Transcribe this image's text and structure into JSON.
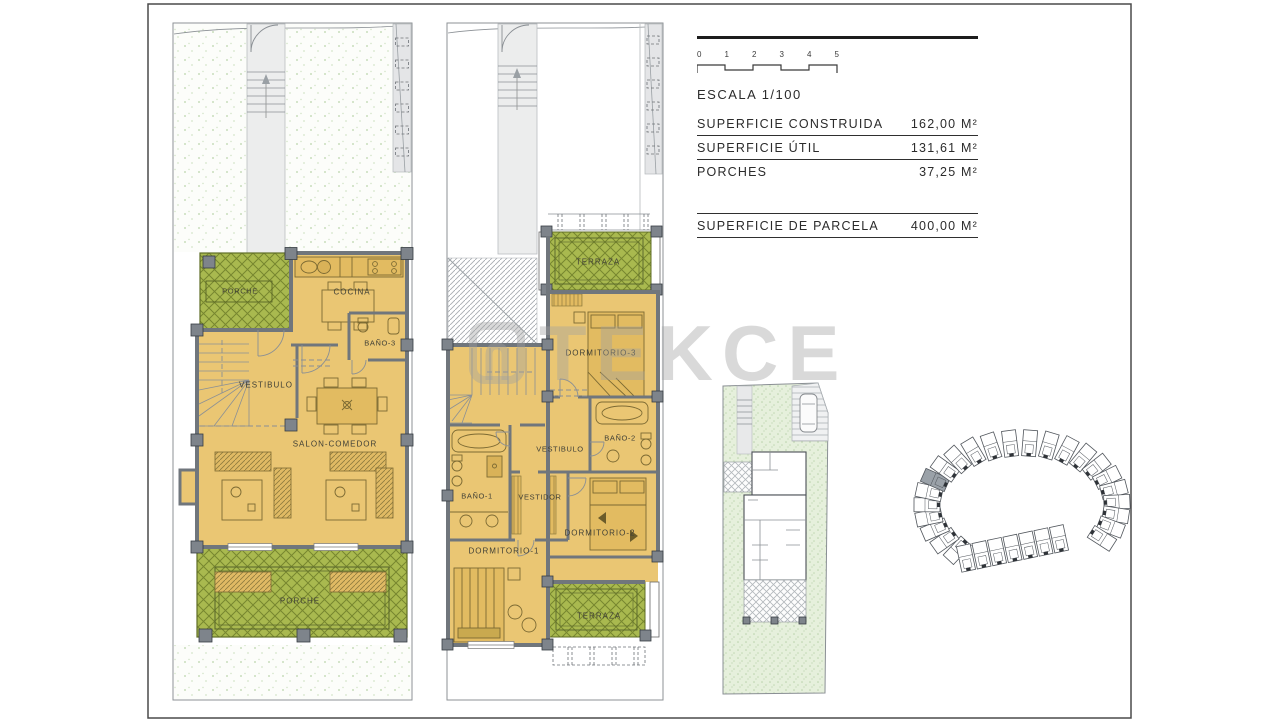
{
  "legend": {
    "scale_label": "ESCALA 1/100",
    "scale_ticks": [
      "0",
      "1",
      "2",
      "3",
      "4",
      "5"
    ],
    "rows": [
      {
        "label": "SUPERFICIE CONSTRUIDA",
        "value": "162,00 M²"
      },
      {
        "label": "SUPERFICIE ÚTIL",
        "value": "131,61 M²"
      },
      {
        "label": "PORCHES",
        "value": "37,25 M²"
      }
    ],
    "parcel": {
      "label": "SUPERFICIE DE PARCELA",
      "value": "400,00 M²"
    }
  },
  "watermark": {
    "text": "TEKCE"
  },
  "floor_plans": {
    "ground": {
      "porche_top": "PORCHE",
      "cocina": "COCINA",
      "bano3": "BAÑO-3",
      "vestibulo": "VESTIBULO",
      "salon": "SALON-COMEDOR",
      "porche_bottom": "PORCHE"
    },
    "first": {
      "terraza_top": "TERRAZA",
      "dormitorio3": "DORMITORIO-3",
      "bano2": "BAÑO-2",
      "vestibulo": "VESTIBULO",
      "bano1": "BAÑO-1",
      "vestidor": "VESTIDOR",
      "dormitorio2": "DORMITORIO-2",
      "dormitorio1": "DORMITORIO-1",
      "terraza_bottom": "TERRAZA"
    }
  },
  "colors": {
    "room_fill": "#eac673",
    "porch_green": "#a9b94f",
    "porch_green_line": "#77862f",
    "garden_speckle": "#c9ddbc",
    "site_green": "#e6f0dc",
    "wall_gray": "#70767c",
    "column_gray": "#7e848b",
    "highlighted_unit": "#9aa1a8",
    "watermark_gray": "#a0a0a0"
  }
}
